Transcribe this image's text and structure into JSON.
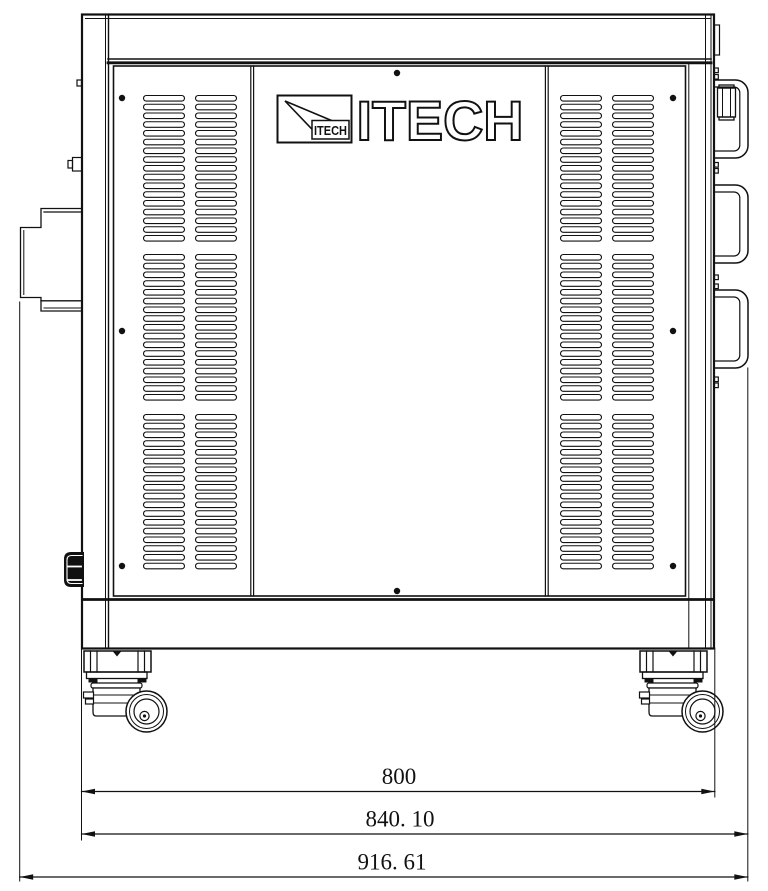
{
  "colors": {
    "line": "#111111",
    "background": "#ffffff"
  },
  "brand": {
    "wordmark": "ITECH",
    "logo_box_text": "ITECH"
  },
  "dimensions": [
    {
      "id": "d800",
      "label": "800",
      "value": 800
    },
    {
      "id": "d840",
      "label": "840. 10",
      "value": 840.1
    },
    {
      "id": "d916",
      "label": "916. 61",
      "value": 916.61
    }
  ],
  "vents": {
    "slot_w": 41,
    "slot_h": 5.6,
    "rx": 2.8,
    "pitch": 8.75,
    "columns_x": [
      143.5,
      195.5,
      560.5,
      612.5
    ],
    "groups": [
      {
        "y": 95.5,
        "count": 17
      },
      {
        "y": 254.5,
        "count": 17
      },
      {
        "y": 414.5,
        "count": 18
      }
    ]
  },
  "screws": {
    "r": 3.2,
    "points": [
      [
        122,
        98
      ],
      [
        122,
        331
      ],
      [
        122,
        566
      ],
      [
        673,
        98
      ],
      [
        673,
        331
      ],
      [
        673,
        566
      ],
      [
        397,
        73
      ],
      [
        397,
        591
      ]
    ]
  },
  "handles": {
    "ys": [
      80,
      185,
      290
    ]
  },
  "edge_ticks": {
    "ys": [
      68,
      74.5,
      162.5,
      168.5,
      275,
      284,
      377,
      383
    ]
  },
  "casters": {
    "offsets": [
      0,
      556
    ]
  }
}
